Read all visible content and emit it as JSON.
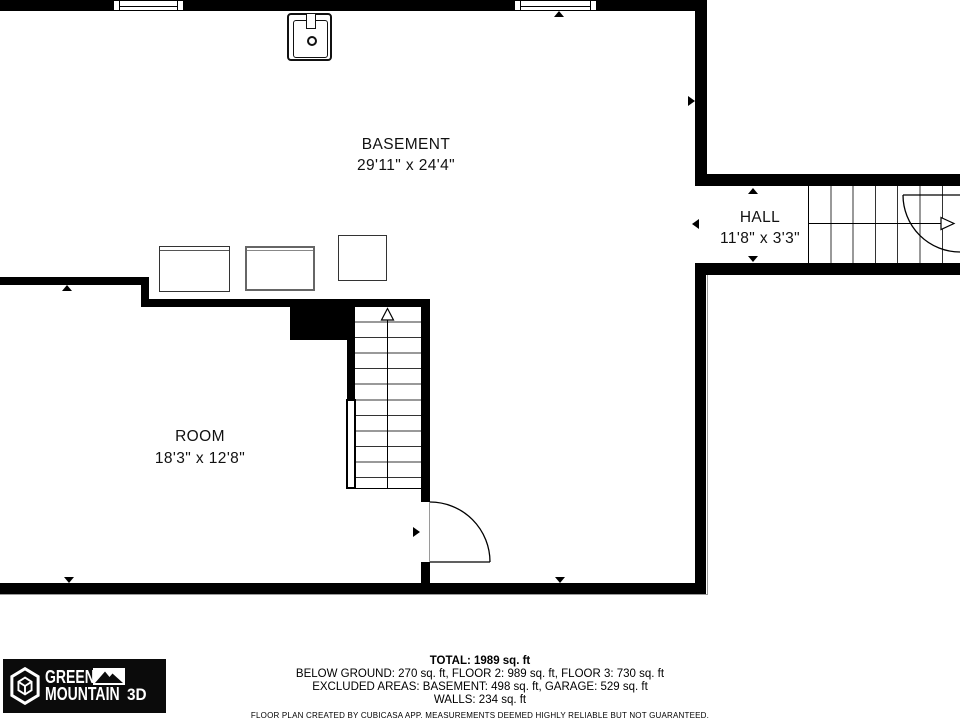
{
  "rooms": {
    "basement": {
      "name": "BASEMENT",
      "dims": "29'11\" x 24'4\""
    },
    "hall": {
      "name": "HALL",
      "dims": "11'8\" x 3'3\""
    },
    "room": {
      "name": "ROOM",
      "dims": "18'3\" x 12'8\""
    }
  },
  "summary": {
    "total": "TOTAL: 1989 sq. ft",
    "floors": "BELOW GROUND: 270 sq. ft, FLOOR 2: 989 sq. ft, FLOOR 3: 730 sq. ft",
    "excluded": "EXCLUDED AREAS: BASEMENT: 498 sq. ft, GARAGE: 529 sq. ft",
    "walls": "WALLS: 234 sq. ft",
    "disclaimer": "FLOOR PLAN CREATED BY CUBICASA APP. MEASUREMENTS DEEMED HIGHLY RELIABLE BUT NOT GUARANTEED."
  },
  "logo": {
    "word1": "GREEN",
    "word2": "MOUNTAIN",
    "word3": "3D"
  },
  "colors": {
    "wall": "#000000",
    "background": "#ffffff",
    "tread_line": "#333333",
    "logo_background": "#0b0b0b"
  }
}
